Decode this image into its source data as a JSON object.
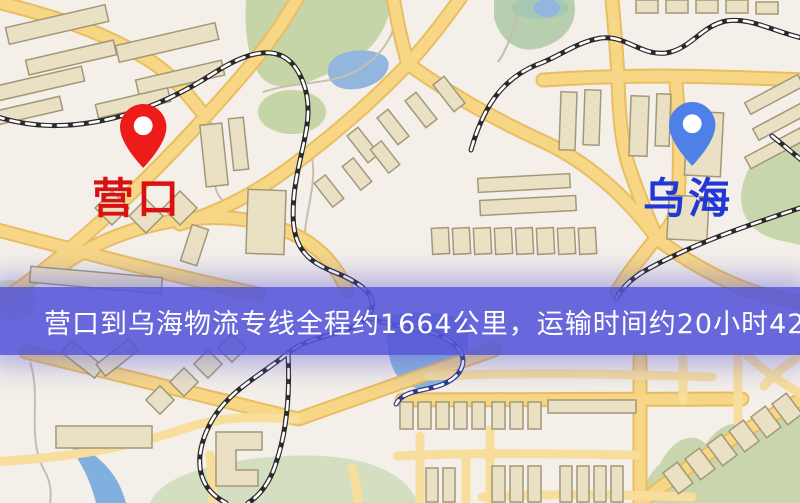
{
  "route": {
    "origin": {
      "label": "营口",
      "label_color": "#db1111",
      "pin_color": "#ee1b1b"
    },
    "destination": {
      "label": "乌海",
      "label_color": "#2337d6",
      "pin_color": "#4f80e8"
    },
    "distance_text": "约1664公里",
    "duration_text": "约20小时42分钟"
  },
  "banner": {
    "text": "营口到乌海物流专线全程约1664公里，运输时间约20小时42分钟.",
    "background_color": "#5454d8",
    "text_color": "#ffffff"
  },
  "map_palette": {
    "background": "#f4efe8",
    "road_casing": "#e9bd62",
    "road_main": "#f7d786",
    "road_minor": "#f8de9c",
    "building_fill": "#eae1c4",
    "building_stroke": "#a29879",
    "park_green": "#c9d6ad",
    "water_blue": "#93b6df",
    "railway_black": "#2a2a2a",
    "railway_over_water": "#2f3a8a"
  }
}
